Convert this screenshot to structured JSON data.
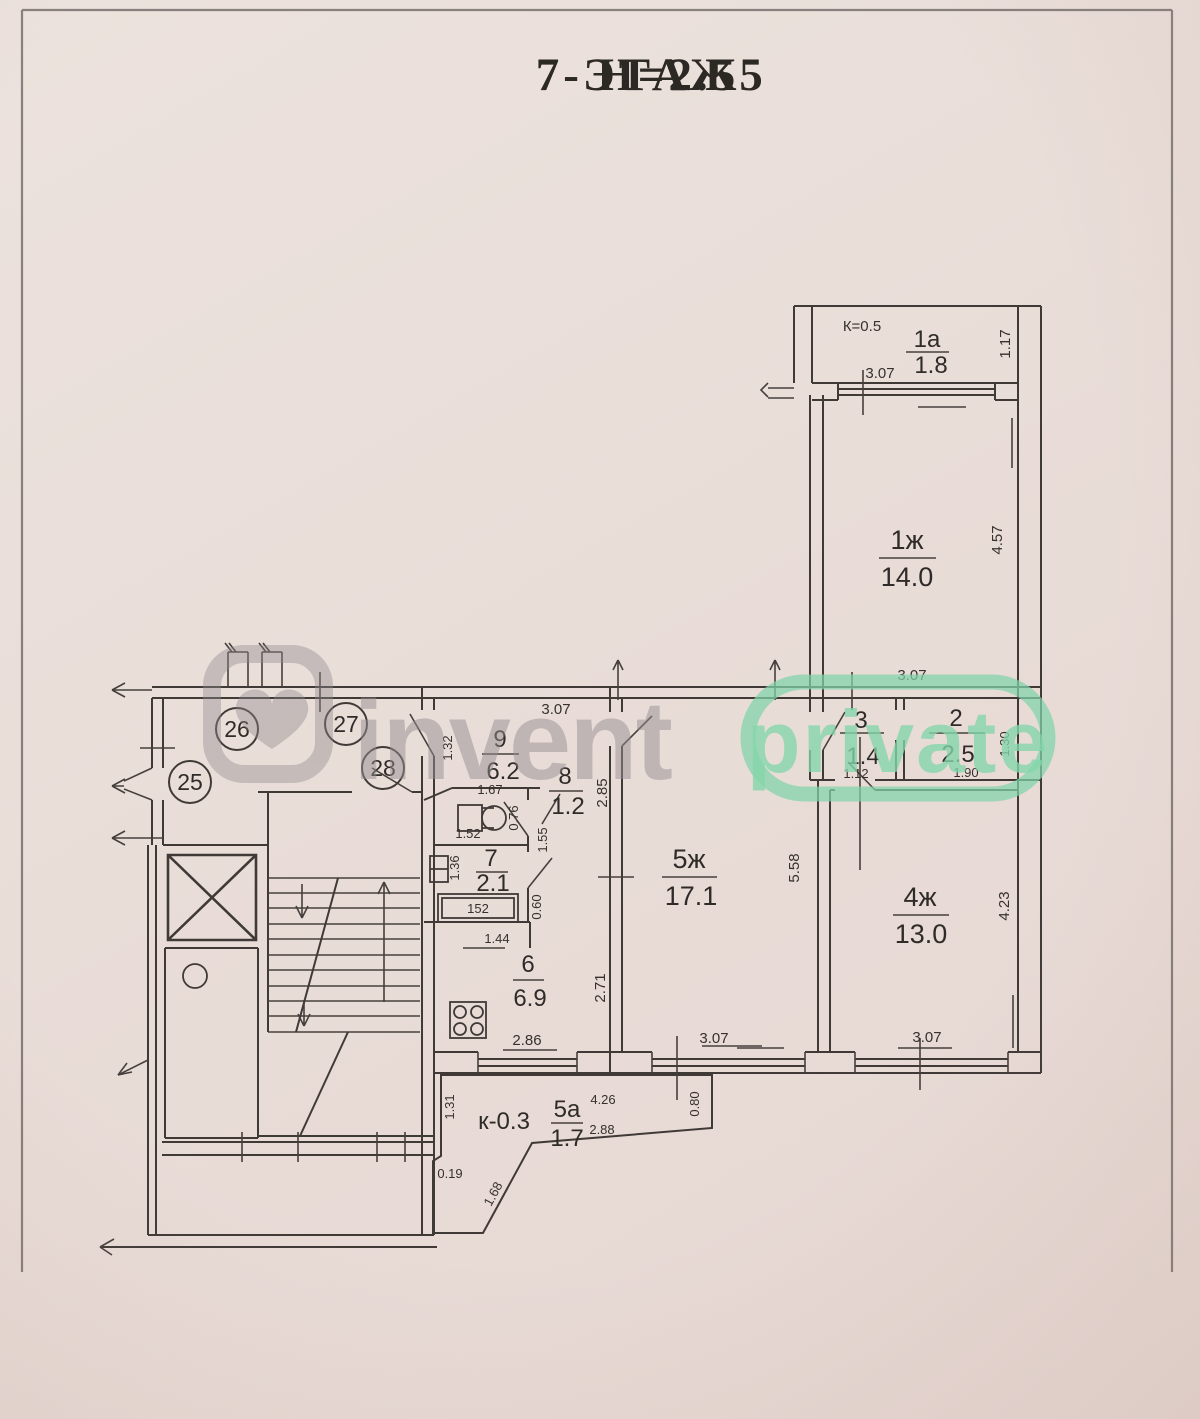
{
  "page": {
    "floor_label": "7-ЭТАЖ",
    "height_label": "Н=2.55"
  },
  "watermark": {
    "brand": "invent",
    "badge": "private"
  },
  "landing_units": [
    "25",
    "26",
    "27",
    "28"
  ],
  "rooms": {
    "balcony1a": {
      "coef": "К=0.5",
      "num": "1а",
      "area": "1.8",
      "dim_w": "3.07",
      "dim_h": "1.17"
    },
    "room1zh": {
      "num": "1ж",
      "area": "14.0",
      "dim_w": "3.07",
      "dim_h": "4.57"
    },
    "room2": {
      "num": "2",
      "area": "2.5",
      "dim_w": "1.90",
      "dim_h": "1.30"
    },
    "room3": {
      "num": "3",
      "area": "1.4",
      "dim_w": "1.12"
    },
    "room4zh": {
      "num": "4ж",
      "area": "13.0",
      "dim_w": "3.07",
      "dim_h": "4.23"
    },
    "room5zh": {
      "num": "5ж",
      "area": "17.1",
      "dim_w": "3.07",
      "dim_h": "5.58",
      "dim_left_upper": "2.85",
      "dim_left_lower": "2.71"
    },
    "corridor9": {
      "num": "9",
      "area": "6.2",
      "dim_w": "3.07",
      "dim_h": "1.32",
      "dim_inner": "1.67"
    },
    "wc8": {
      "num": "8",
      "area": "1.2",
      "dim_h": "0.76",
      "dim_lobby": "1.55",
      "dim_w": "1.52"
    },
    "bath7": {
      "num": "7",
      "area": "2.1",
      "dim_h": "1.36",
      "tub": "152"
    },
    "kitchen6": {
      "num": "6",
      "area": "6.9",
      "dim_top": "1.44",
      "dim_w": "2.86",
      "dim_pass": "0.60"
    },
    "balcony5a": {
      "coef": "к-0.3",
      "num": "5а",
      "area": "1.7",
      "dim_top": "4.26",
      "dim_diag": "2.88",
      "dim_left": "1.31",
      "dim_step": "0.19",
      "dim_slope": "1.68",
      "dim_right": "0.80"
    }
  }
}
